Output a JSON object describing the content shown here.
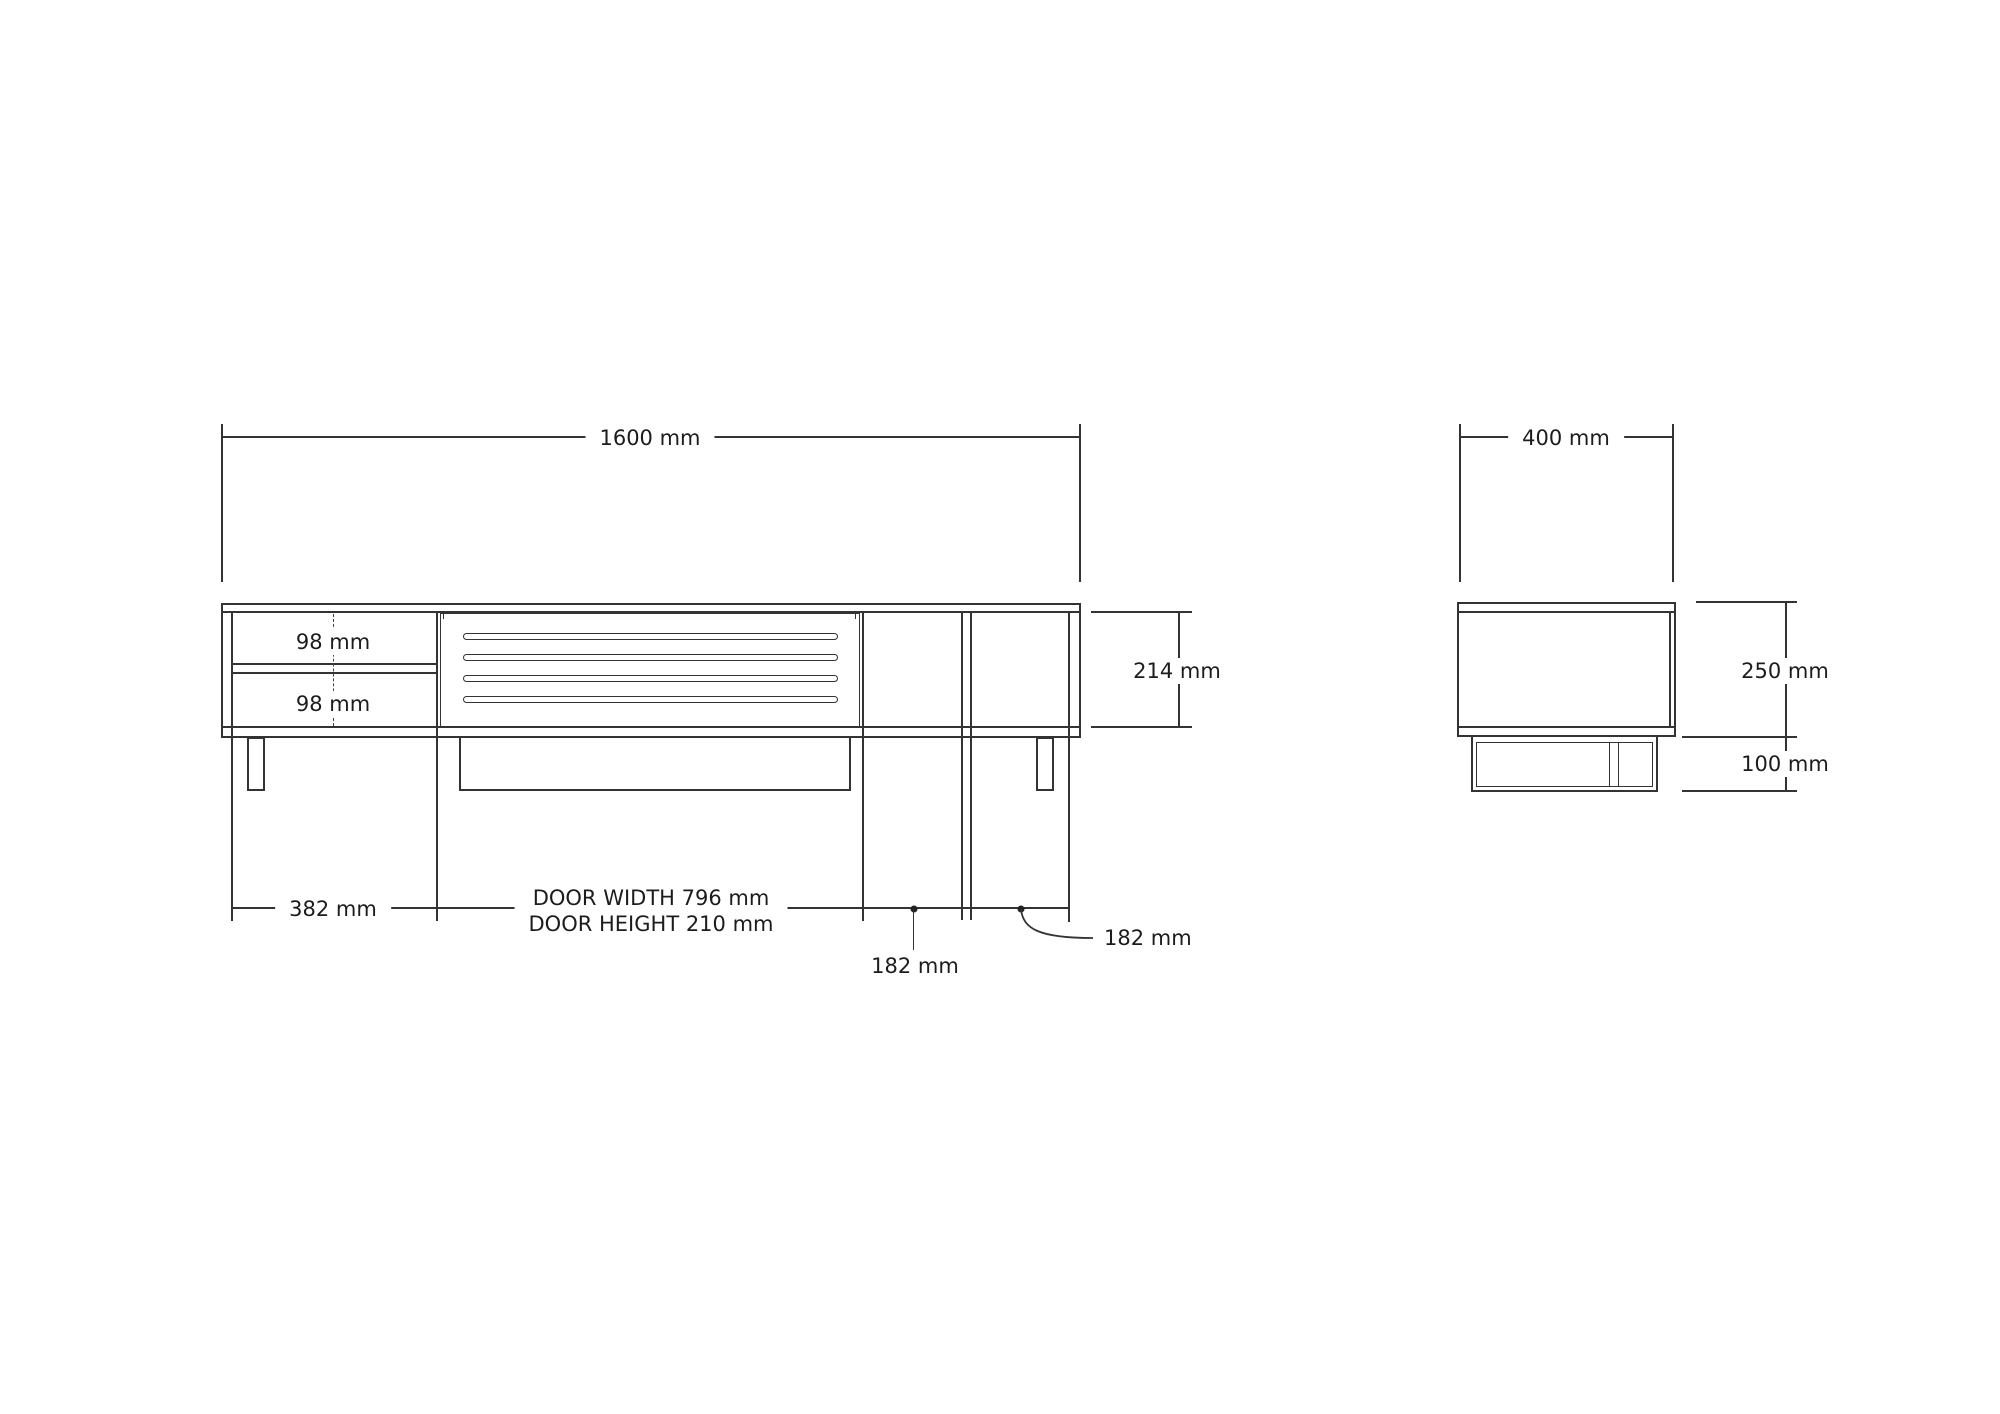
{
  "drawing": {
    "front_view": {
      "overall_width_label": "1600 mm",
      "carcass_height_label": "214 mm",
      "drawer_top_label": "98 mm",
      "drawer_bottom_label": "98 mm",
      "left_section_width_label": "382 mm",
      "door_label_line1": "DOOR WIDTH 796 mm",
      "door_label_line2": "DOOR HEIGHT 210 mm",
      "shelf_left_width_label": "182 mm",
      "shelf_right_width_label": "182 mm"
    },
    "side_view": {
      "depth_label": "400 mm",
      "body_height_label": "250 mm",
      "base_height_label": "100 mm"
    },
    "colors": {
      "line": "#333333",
      "text": "#1c1c1c",
      "background": "#ffffff"
    }
  }
}
